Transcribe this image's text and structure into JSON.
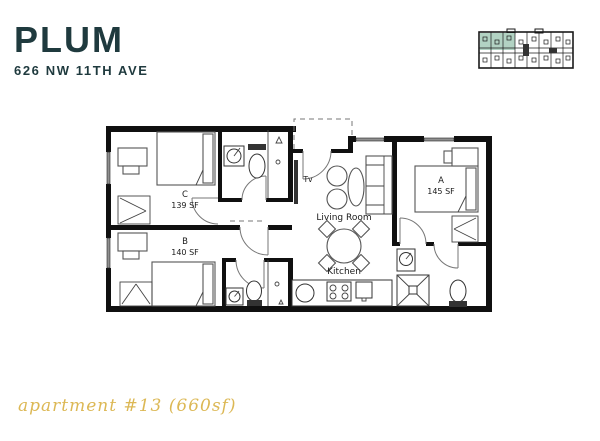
{
  "header": {
    "title": "PLUM",
    "address": "626 NW 11TH AVE"
  },
  "caption": "apartment #13 (660sf)",
  "colors": {
    "title": "#1f3a3e",
    "caption": "#dcb855",
    "highlight": "#b2d3c3",
    "wall": "#101010",
    "window": "#8f8f8f"
  },
  "floor_plan": {
    "rooms": {
      "a": {
        "label": "A",
        "area": "145 SF"
      },
      "b": {
        "label": "B",
        "area": "140 SF"
      },
      "c": {
        "label": "C",
        "area": "139 SF"
      },
      "living": {
        "label": "Living Room"
      },
      "kitchen": {
        "label": "Kitchen"
      }
    },
    "tv_label": "Tv"
  }
}
